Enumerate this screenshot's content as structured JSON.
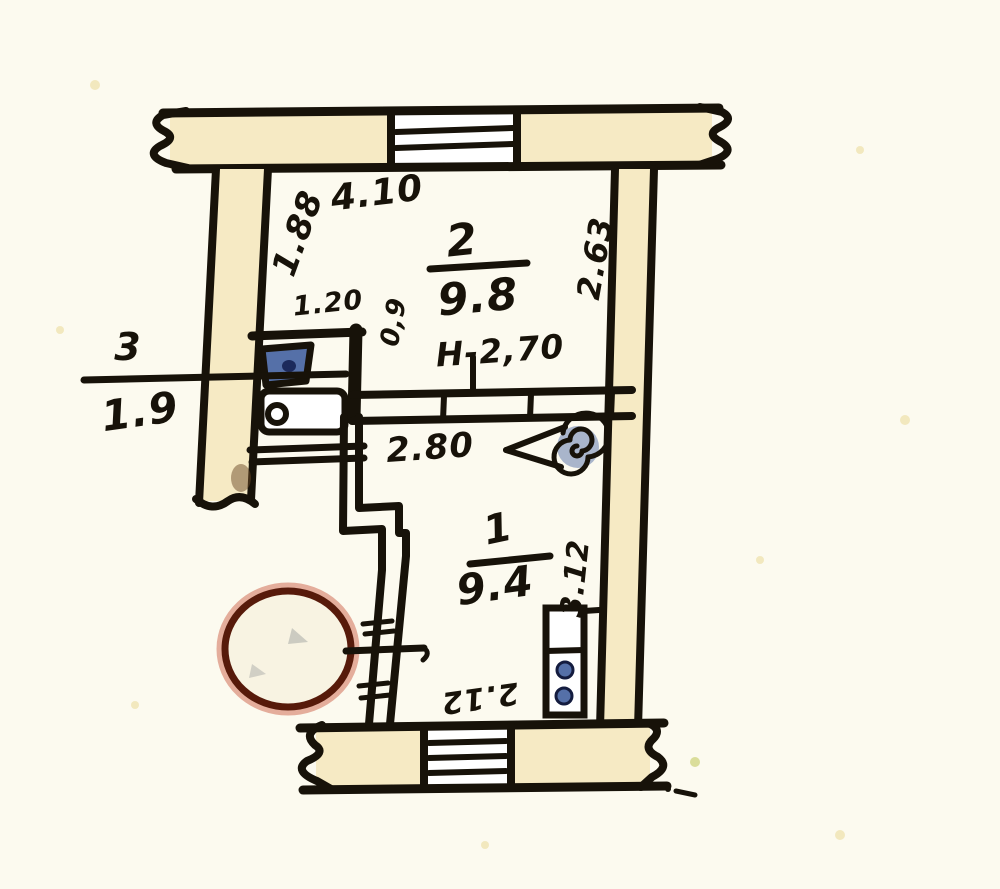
{
  "document": {
    "kind_label": "hand-drawn apartment floor plan"
  },
  "rooms": [
    {
      "number": "2",
      "area": "9.8"
    },
    {
      "number": "1",
      "area": "9.4"
    },
    {
      "number": "3",
      "area": "1.9"
    }
  ],
  "dimensions": {
    "top_width": "4.10",
    "room2_left_height": "1.88",
    "room2_right_height": "2.63",
    "niche_width": "1.20",
    "niche_depth": "0,9",
    "ceiling_height": "H-2,70",
    "partition_length": "2.80",
    "room1_right_height": "3.12",
    "room1_bottom_width": "2.12"
  },
  "symbols": {
    "stamp": "round-stamp-circle",
    "door": "door-swing-with-scribble",
    "sink": "kitchen-sink",
    "stove": "kitchen-stove",
    "vent": "vent-shaft-two-ports",
    "window": "window-glazing-lines",
    "wall_break": "wall-break-squiggle"
  },
  "palette": {
    "paper": "#fcfaef",
    "wall_fill": "#f6eac4",
    "ink": "#171209",
    "fixture_blue": "#5570a8",
    "fixture_blue_dark": "#1c2a5c",
    "stamp_red": "#571a0a",
    "stamp_fringe": "#c03a1e",
    "speckle": "#efe2ad",
    "window_white": "#ffffff"
  }
}
